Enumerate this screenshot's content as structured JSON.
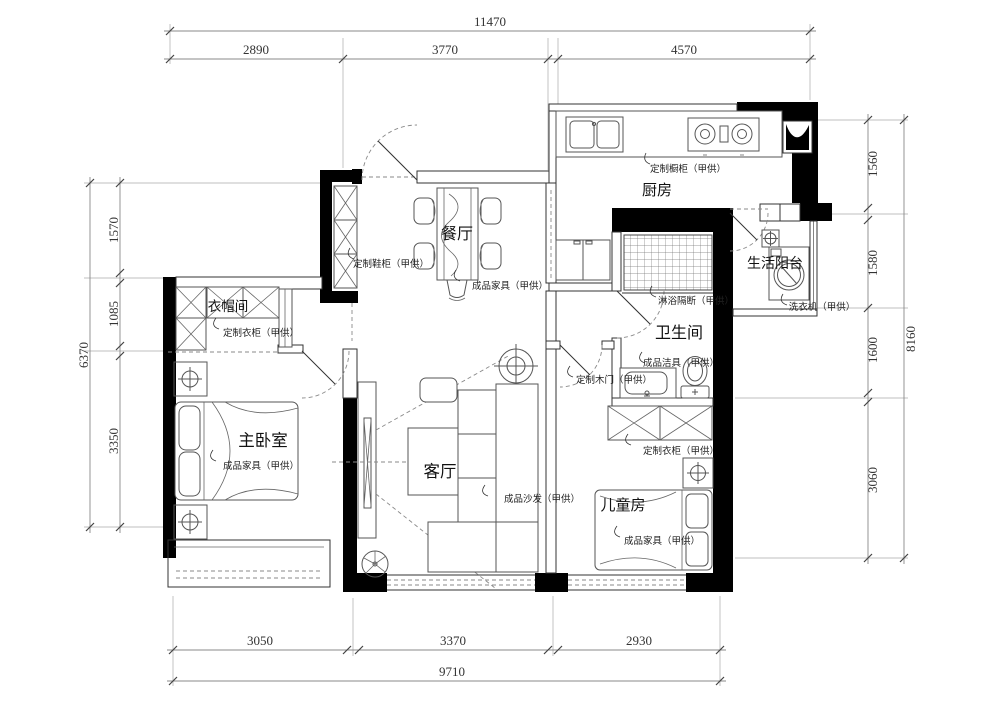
{
  "rooms": {
    "kitchen": "厨房",
    "dining": "餐厅",
    "balcony": "生活阳台",
    "bathroom": "卫生间",
    "cloakroom": "衣帽间",
    "master_bedroom": "主卧室",
    "living_room": "客厅",
    "kids_room": "儿童房"
  },
  "annotations": {
    "kitchen_cabinet": "定制橱柜（甲供）",
    "shoe_cabinet": "定制鞋柜（甲供）",
    "dining_furniture": "成品家具（甲供）",
    "washing_machine": "洗衣机（甲供）",
    "shower_partition": "淋浴隔断（甲供）",
    "sanitary_ware": "成品洁具（甲供）",
    "wood_door": "定制木门（甲供）",
    "kids_wardrobe": "定制衣柜（甲供）",
    "cloak_wardrobe": "定制衣柜（甲供）",
    "bedroom_furniture": "成品家具（甲供）",
    "sofa": "成品沙发（甲供）",
    "kids_furniture": "成品家具（甲供）"
  },
  "dimensions": {
    "top": {
      "total": "11470",
      "segments": [
        "2890",
        "3770",
        "4570"
      ]
    },
    "bottom": {
      "total": "9710",
      "segments": [
        "3050",
        "3370",
        "2930"
      ]
    },
    "left": {
      "total": "6370",
      "segments": [
        "1570",
        "1085",
        "3350"
      ]
    },
    "right": {
      "total": "8160",
      "segments": [
        "1560",
        "1580",
        "1600",
        "3060"
      ]
    }
  },
  "colors": {
    "wall": "#000000",
    "line": "#333333",
    "dimension": "#888888",
    "background": "#ffffff"
  }
}
